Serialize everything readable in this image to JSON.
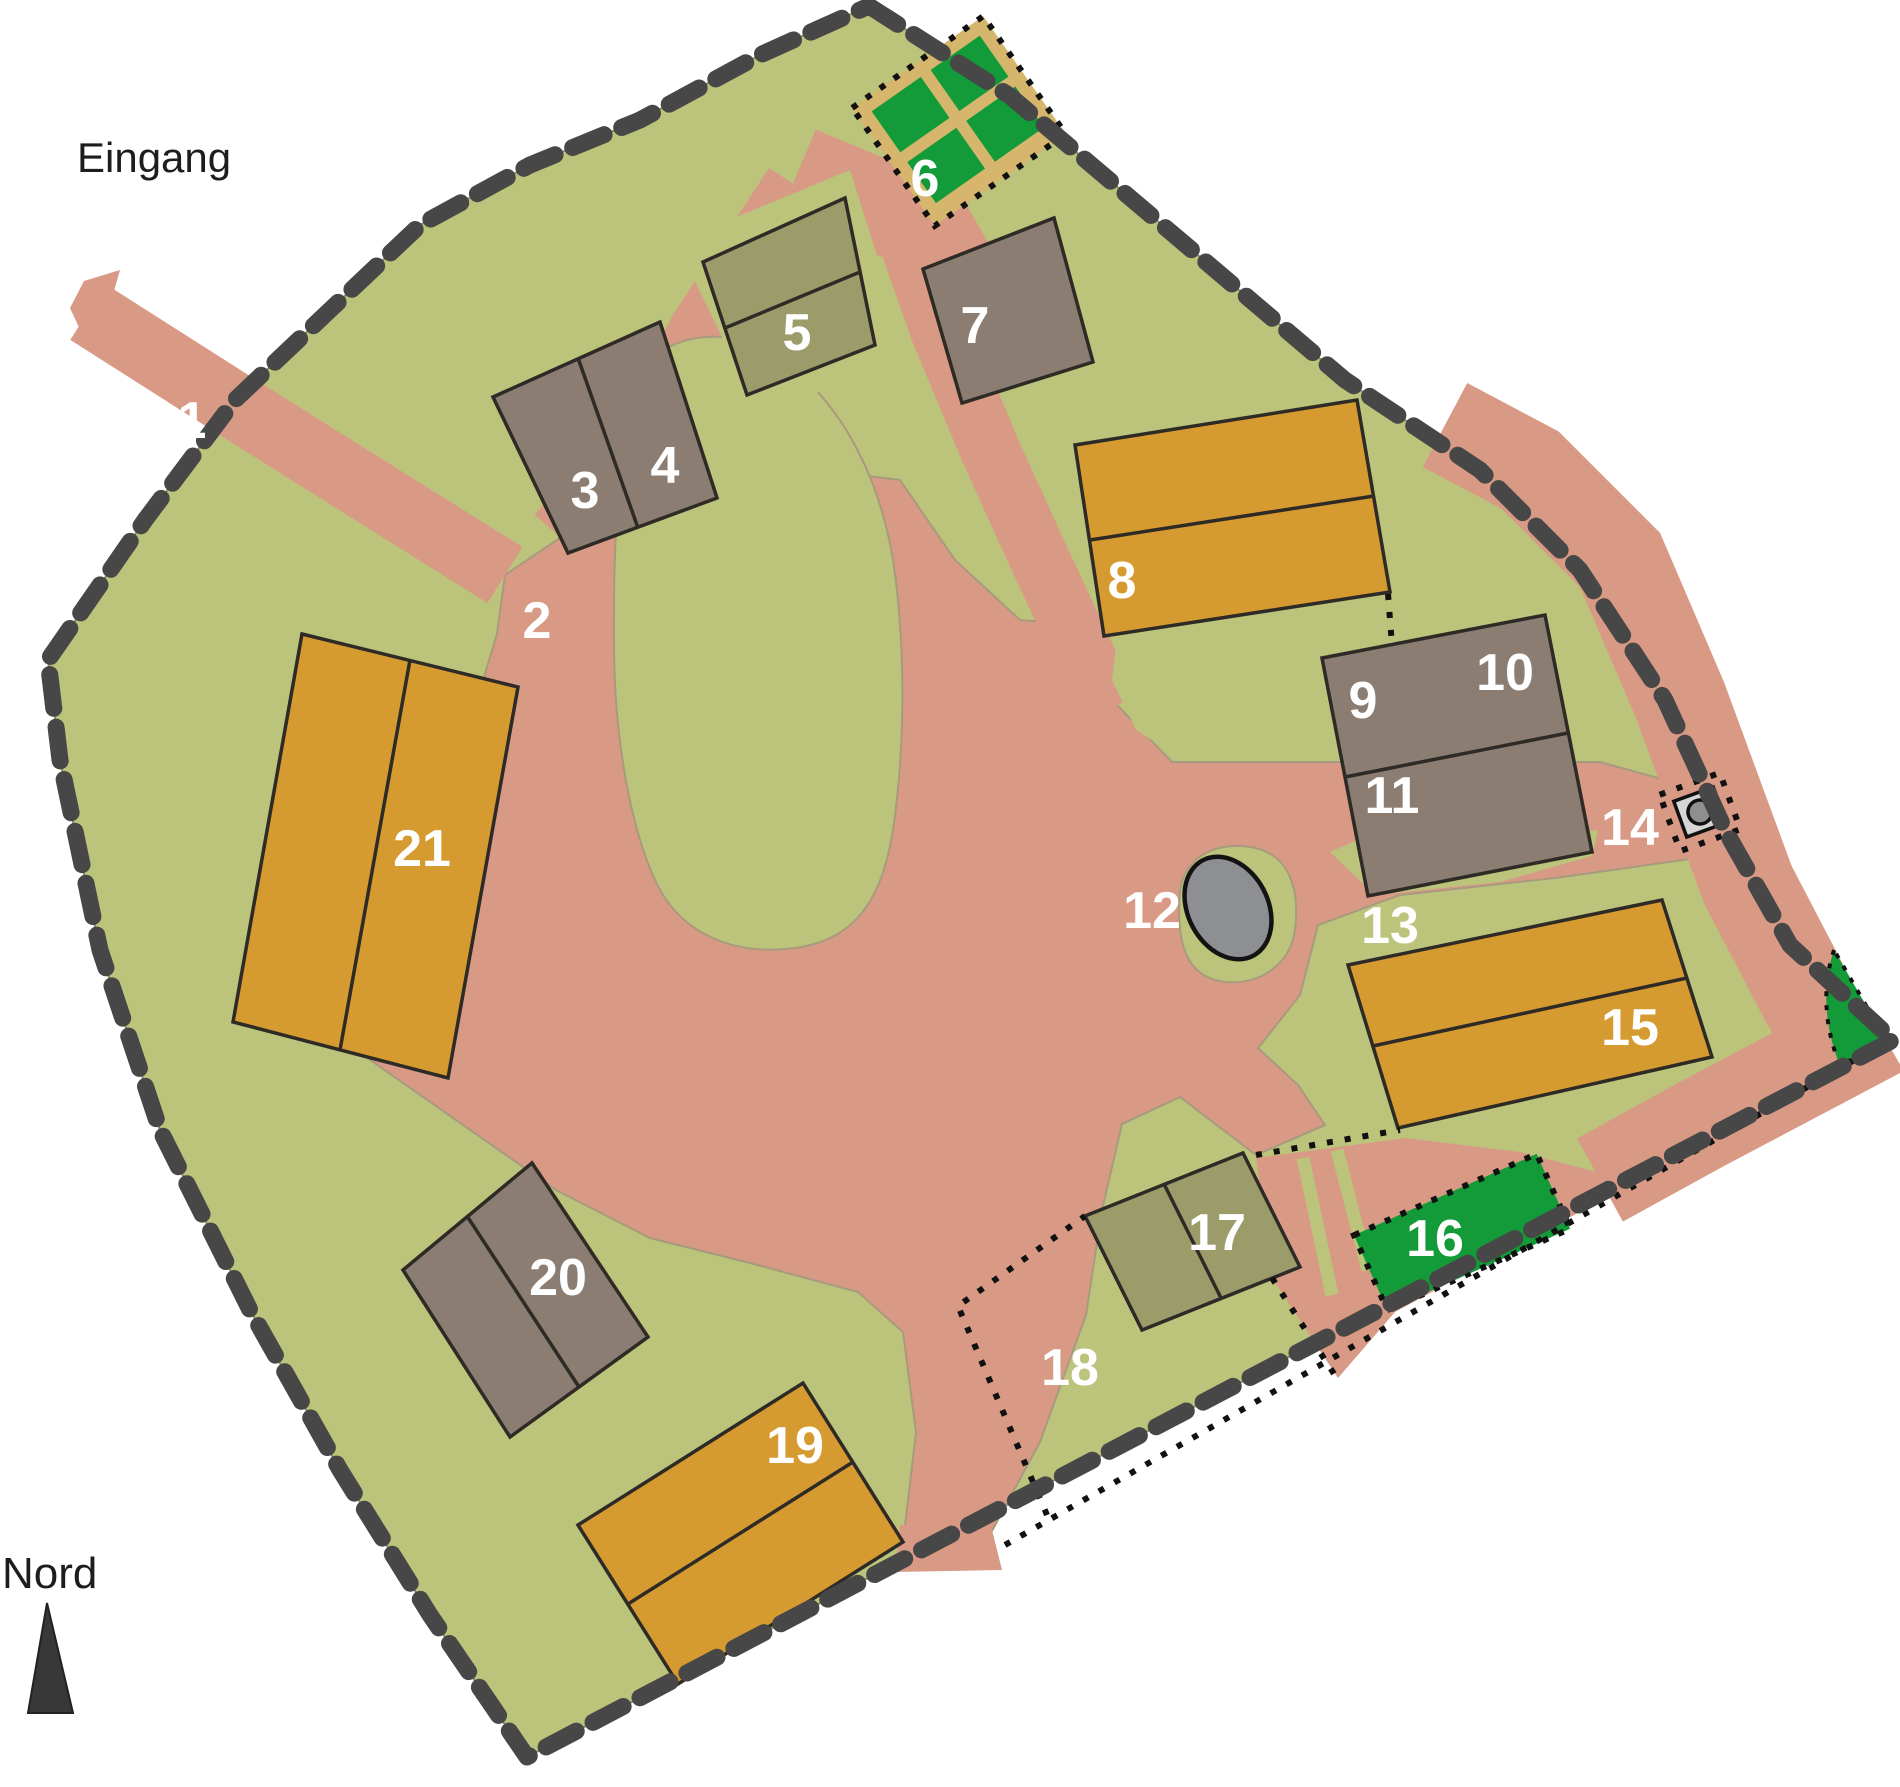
{
  "map": {
    "title_labels": {
      "entrance": "Eingang",
      "north": "Nord"
    },
    "colors": {
      "background": "#ffffff",
      "grass": "#bcc37b",
      "path": "#d89a85",
      "path_edge": "#9e9276",
      "building_gray": "#8b7d71",
      "building_olive": "#9c9c6b",
      "building_orange": "#d69b30",
      "garden_green": "#129b38",
      "garden_path_tan": "#d6b56d",
      "pond_gray": "#8d8f93",
      "boundary_dash": "#474747",
      "dotted_line": "#111111",
      "label_white": "#ffffff",
      "text_black": "#1d1d1d"
    },
    "feature_labels": [
      {
        "id": "1",
        "x": 192,
        "y": 438
      },
      {
        "id": "2",
        "x": 537,
        "y": 638
      },
      {
        "id": "3",
        "x": 585,
        "y": 508
      },
      {
        "id": "4",
        "x": 665,
        "y": 483
      },
      {
        "id": "5",
        "x": 797,
        "y": 350
      },
      {
        "id": "6",
        "x": 925,
        "y": 196
      },
      {
        "id": "7",
        "x": 975,
        "y": 343
      },
      {
        "id": "8",
        "x": 1122,
        "y": 598
      },
      {
        "id": "9",
        "x": 1363,
        "y": 718
      },
      {
        "id": "10",
        "x": 1505,
        "y": 690
      },
      {
        "id": "11",
        "x": 1392,
        "y": 813
      },
      {
        "id": "12",
        "x": 1152,
        "y": 928
      },
      {
        "id": "13",
        "x": 1390,
        "y": 943
      },
      {
        "id": "14",
        "x": 1630,
        "y": 845
      },
      {
        "id": "15",
        "x": 1630,
        "y": 1045
      },
      {
        "id": "16",
        "x": 1435,
        "y": 1256
      },
      {
        "id": "17",
        "x": 1217,
        "y": 1250
      },
      {
        "id": "18",
        "x": 1070,
        "y": 1385
      },
      {
        "id": "19",
        "x": 795,
        "y": 1463
      },
      {
        "id": "20",
        "x": 558,
        "y": 1295
      },
      {
        "id": "21",
        "x": 422,
        "y": 866
      }
    ]
  }
}
